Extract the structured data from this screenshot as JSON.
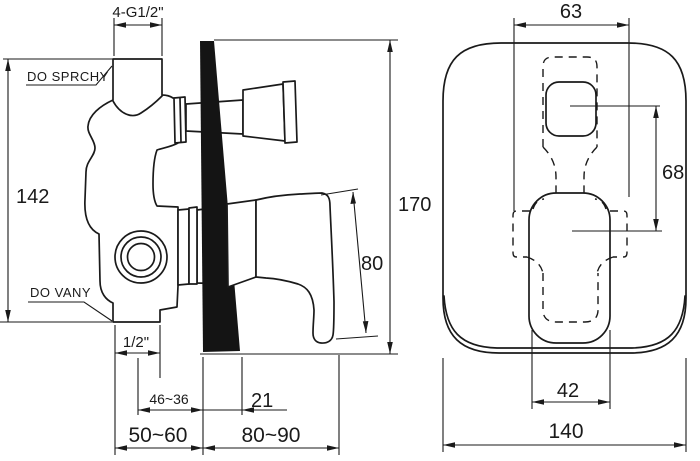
{
  "drawing": {
    "type": "technical-dimension-drawing",
    "colors": {
      "line": "#1a1a1a",
      "wall_section": "#141414",
      "background": "#ffffff"
    },
    "side": {
      "thread_top": "4-G1/2\"",
      "to_shower": "DO SPRCHY",
      "height_total": "142",
      "to_bath": "DO VANY",
      "thread_bottom": "1/2\"",
      "depth_range_small": "46~36",
      "offset_front": "21",
      "recess_depth": "50~60",
      "protrusion": "80~90",
      "handle_height": "80",
      "overall_height": "170"
    },
    "front": {
      "plate_inner_width": "63",
      "centres_distance": "68",
      "lever_width": "42",
      "plate_width": "140"
    }
  }
}
